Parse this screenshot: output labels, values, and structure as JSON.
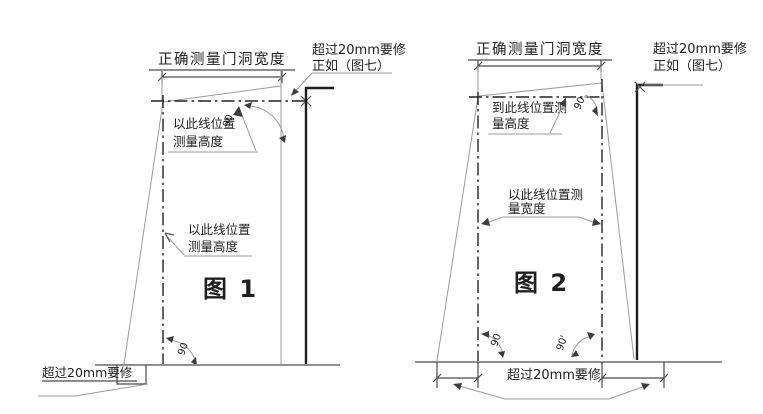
{
  "palette": {
    "background": "#ffffff",
    "caption_red": "#f10000",
    "line_dark": "#1c1c1c",
    "line_thin": "#9b9b9b"
  },
  "figure1": {
    "caption": "图 1",
    "width_dim_label": "正确测量门洞宽度",
    "fix_note": {
      "line1": "超过20mm要修",
      "line2": "正如（图七）"
    },
    "height_note_top": {
      "line1": "以此线位置",
      "line2": "测量高度"
    },
    "height_note_side": {
      "line1": "以此线位置",
      "line2": "测量高度"
    },
    "angle_top": "90",
    "angle_bottom": "90",
    "floor_fix_note": "超过20mm要修"
  },
  "figure2": {
    "caption": "图 2",
    "width_dim_label": "正确测量门洞宽度",
    "fix_note": {
      "line1": "超过20mm要修",
      "line2": "正如（图七）"
    },
    "height_note": {
      "line1": "到此线位置测",
      "line2": "量高度"
    },
    "width_note": {
      "line1": "以此线位置测",
      "line2": "量宽度"
    },
    "angle_top": "90.",
    "angle_bottom_left": "90",
    "angle_bottom_right": "90'",
    "floor_fix_note": "超过20mm要修"
  }
}
